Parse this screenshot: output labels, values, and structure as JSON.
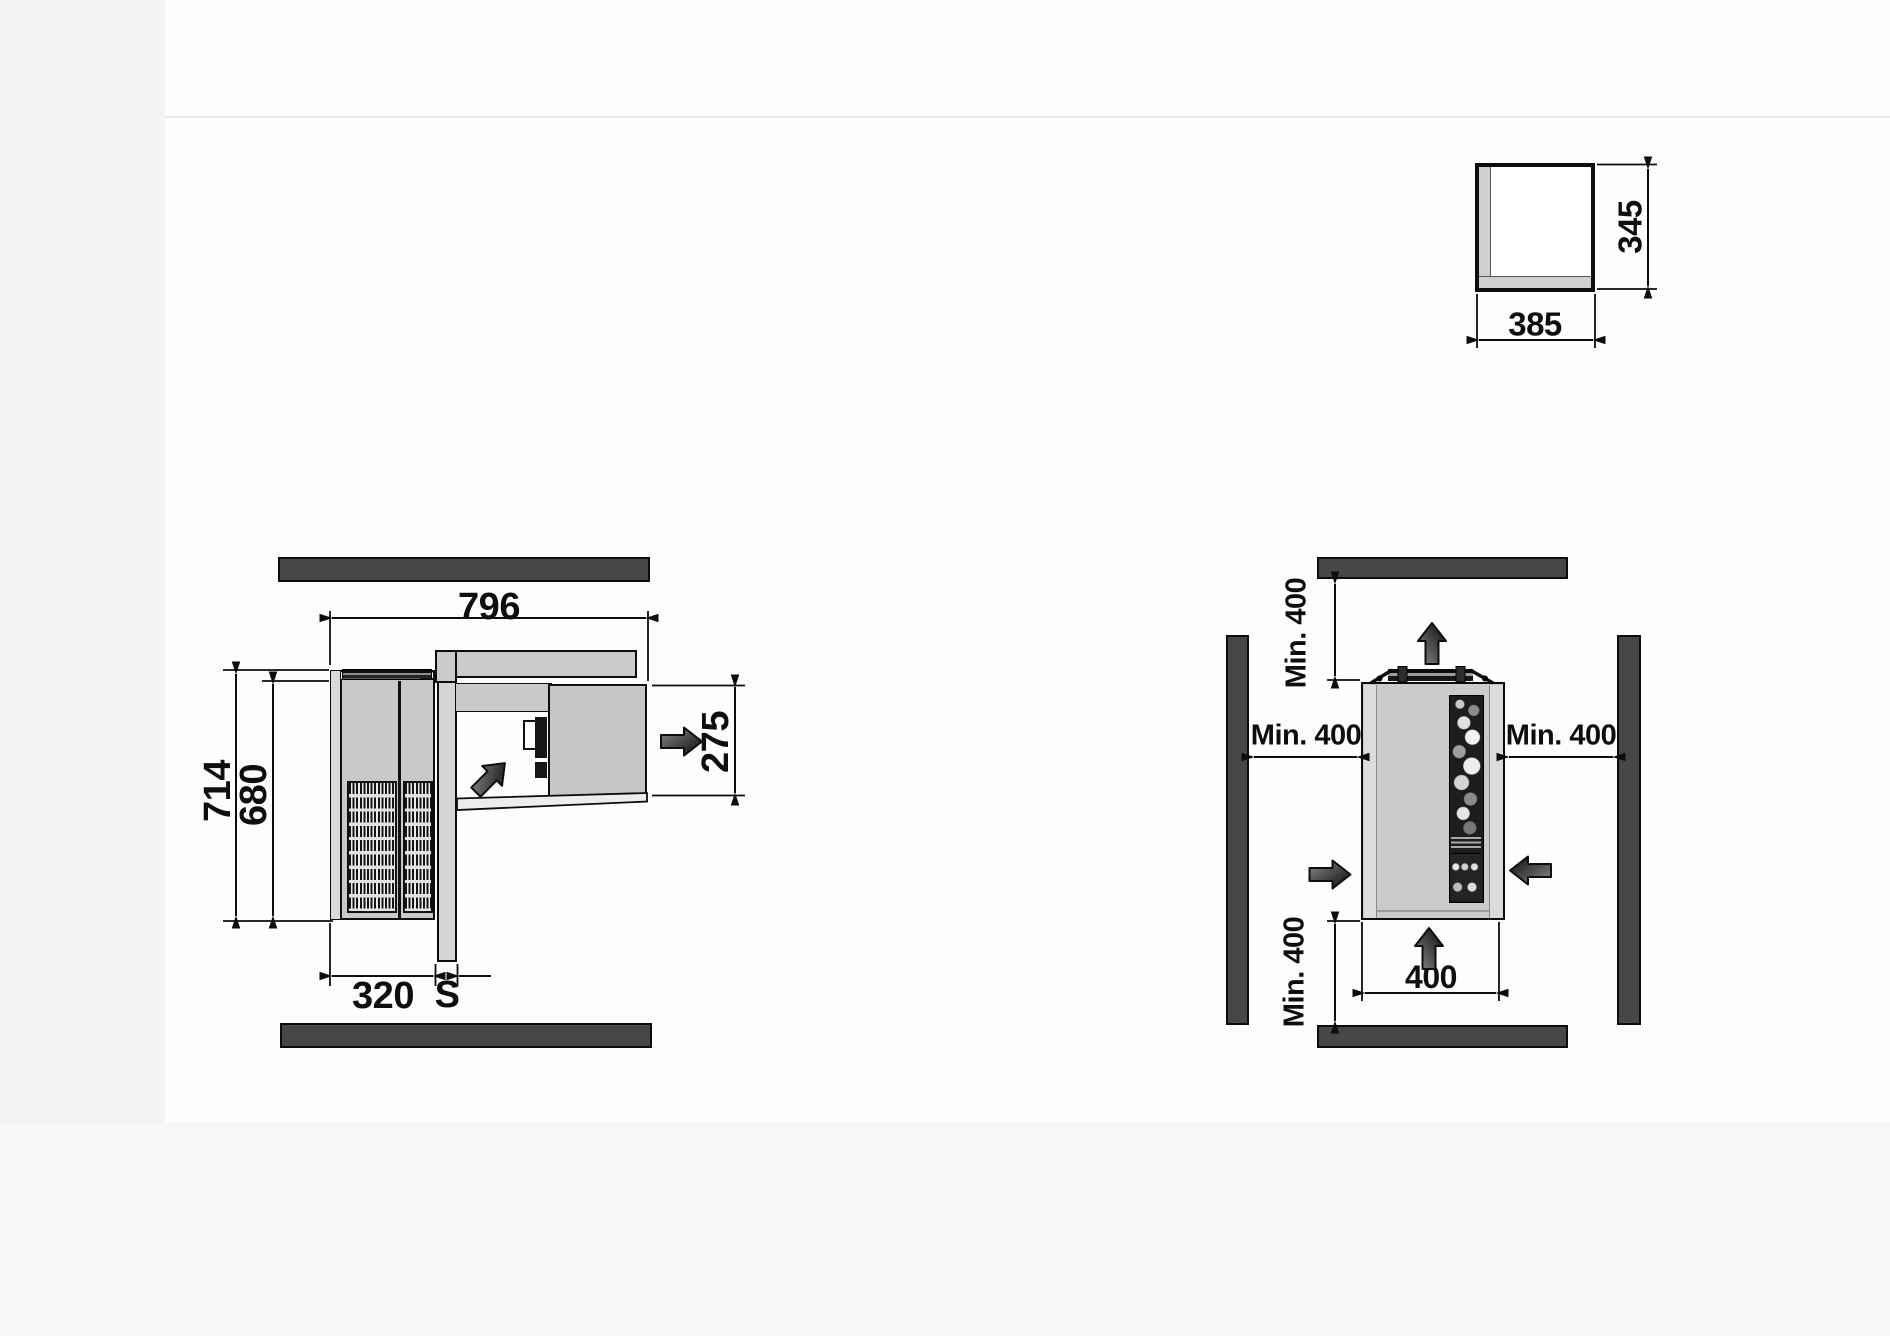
{
  "top_view": {
    "overall_width": "796",
    "overall_depth": "714",
    "body_depth": "680",
    "external_section_width": "320",
    "wall_thickness": "S",
    "internal_section_depth": "275"
  },
  "front_view": {
    "clearance_above": "Min. 400",
    "clearance_left": "Min. 400",
    "clearance_right": "Min. 400",
    "clearance_below": "Min. 400",
    "unit_width": "400"
  },
  "wall_cutout": {
    "width": "385",
    "height": "345"
  },
  "colors": {
    "wall_fill": "#474747",
    "panel_light": "#cbcbcb",
    "panel_mid": "#c9c9c9",
    "line": "#0d0d0d"
  },
  "icons": {
    "airflow_up": "airflow-up-arrow-icon",
    "airflow_right": "airflow-right-arrow-icon",
    "airflow_left": "airflow-left-arrow-icon",
    "airflow_diagonal": "airflow-diagonal-arrow-icon"
  }
}
